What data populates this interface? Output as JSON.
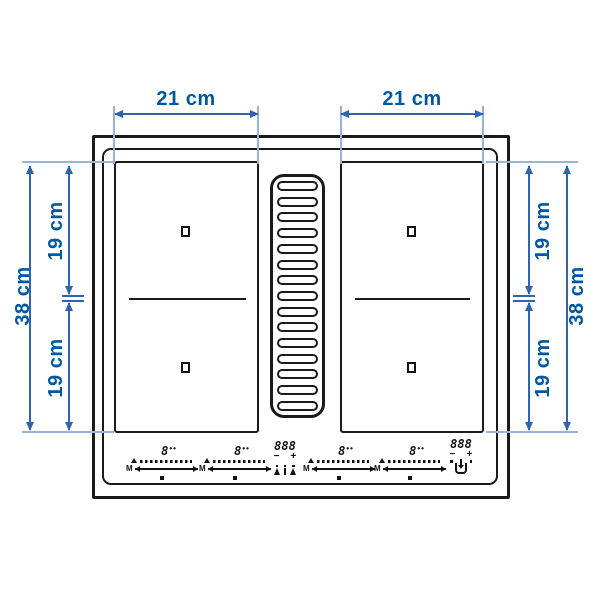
{
  "dimensions": {
    "top_left_width": "21 cm",
    "top_right_width": "21 cm",
    "left_total_height": "38 cm",
    "left_upper_height": "19 cm",
    "left_lower_height": "19 cm",
    "right_total_height": "38 cm",
    "right_upper_height": "19 cm",
    "right_lower_height": "19 cm"
  },
  "controls": {
    "zone_power_display": "8",
    "zone_power_dots": "••",
    "manual_label": "M",
    "timer_display": "888",
    "minus_label": "−",
    "plus_label": "+"
  },
  "icons": {
    "center_cluster": [
      "boost-figure-icon",
      "pause-bar-icon",
      "boost-figure-icon"
    ],
    "right_cluster": [
      "extractor-hood-icon"
    ],
    "zone_slider": "double-arrow-line",
    "zone_levels": "power-level-dot-ramp"
  },
  "colors": {
    "dimension_text": "#0058a3",
    "dimension_line": "#2e64ad",
    "extension_line": "#9ab2d8",
    "outline_black": "#1a1a1a",
    "background": "#ffffff"
  }
}
